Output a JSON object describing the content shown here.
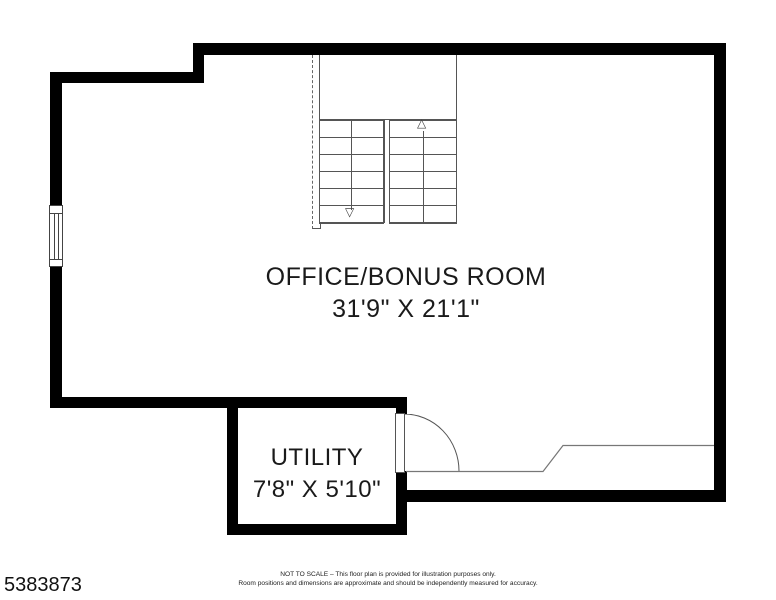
{
  "floorplan": {
    "rooms": {
      "office": {
        "name": "OFFICE/BONUS ROOM",
        "dimensions": "31'9\" X 21'1\""
      },
      "utility": {
        "name": "UTILITY",
        "dimensions": "7'8\" X 5'10\""
      }
    },
    "stairs": {
      "up_arrow": "△",
      "down_arrow": "▽"
    }
  },
  "footer": {
    "listing_id": "5383873",
    "disclaimer_line1": "NOT TO SCALE – This floor plan is provided for illustration purposes only.",
    "disclaimer_line2": "Room positions and dimensions are approximate and should be independently measured for accuracy."
  },
  "colors": {
    "wall": "#000000",
    "thin_line": "#555555",
    "step_line": "#777777",
    "background": "#ffffff"
  }
}
